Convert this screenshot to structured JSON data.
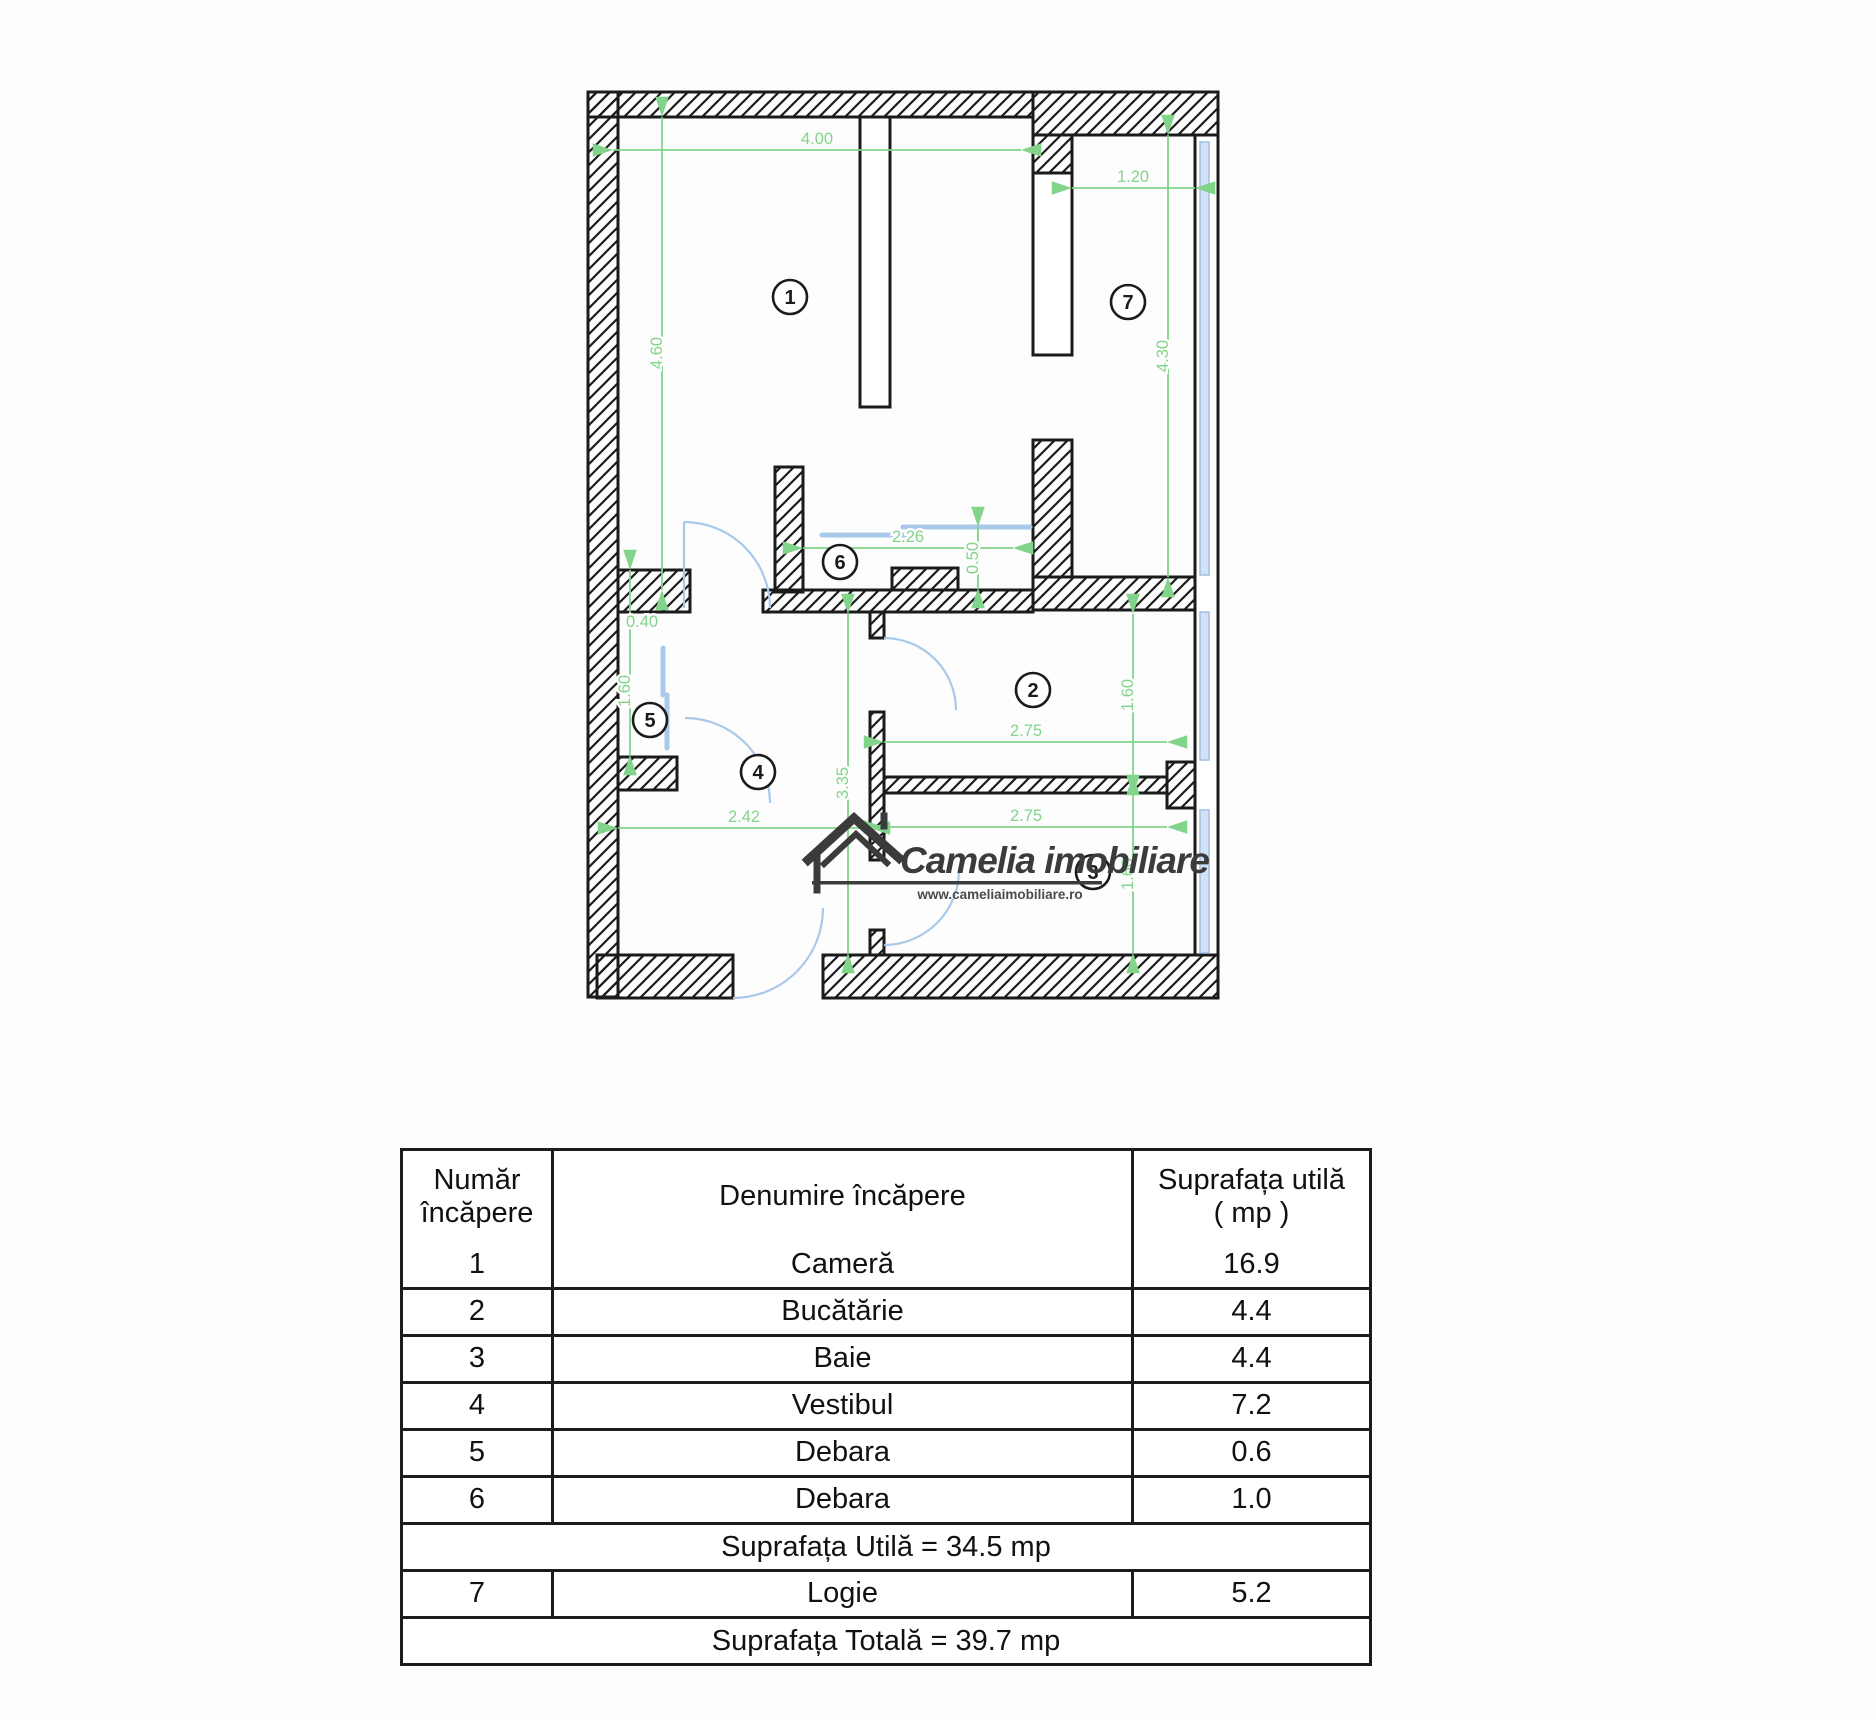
{
  "logo": {
    "name": "Camelia imobiliare",
    "url": "www.cameliaimobiliare.ro"
  },
  "plan": {
    "colors": {
      "dimension_green": "#82d48a",
      "fixture_blue": "#a9c9ea",
      "glass_blue": "#d3e2f4",
      "wall_black": "#1b1b1b",
      "logo_gray": "#3b3b3b"
    },
    "dimensions": [
      {
        "label": "4.00",
        "x1": 143,
        "y1": 100,
        "x2": 551,
        "y2": 100,
        "lx": 347,
        "ly": 94,
        "rot": false
      },
      {
        "label": "4.60",
        "x1": 192,
        "y1": 67,
        "x2": 192,
        "y2": 540,
        "lx": 192,
        "ly": 303,
        "rot": true
      },
      {
        "label": "1.20",
        "x1": 602,
        "y1": 138,
        "x2": 725,
        "y2": 138,
        "lx": 663,
        "ly": 132,
        "rot": false
      },
      {
        "label": "4.30",
        "x1": 698,
        "y1": 85,
        "x2": 698,
        "y2": 527,
        "lx": 698,
        "ly": 306,
        "rot": true
      },
      {
        "label": "2.26",
        "x1": 333,
        "y1": 498,
        "x2": 543,
        "y2": 498,
        "lx": 438,
        "ly": 492,
        "rot": false
      },
      {
        "label": "0.50",
        "x1": 508,
        "y1": 477,
        "x2": 508,
        "y2": 538,
        "lx": 508,
        "ly": 508,
        "rot": true
      },
      {
        "label": "0.40",
        "x1": 160,
        "y1": 520,
        "x2": 160,
        "y2": 705,
        "lx": 172,
        "ly": 577,
        "rot": false
      },
      {
        "label": "1.60",
        "lx": 160,
        "ly": 641,
        "rot": true
      },
      {
        "label": "2.42",
        "x1": 148,
        "y1": 778,
        "x2": 400,
        "y2": 778,
        "lx": 274,
        "ly": 772,
        "rot": false
      },
      {
        "label": "3.35",
        "x1": 378,
        "y1": 564,
        "x2": 378,
        "y2": 903,
        "lx": 378,
        "ly": 733,
        "rot": true
      },
      {
        "label": "2.75",
        "x1": 414,
        "y1": 692,
        "x2": 697,
        "y2": 692,
        "lx": 556,
        "ly": 686,
        "rot": false
      },
      {
        "label": "1.60",
        "x1": 663,
        "y1": 564,
        "x2": 663,
        "y2": 725,
        "lx": 663,
        "ly": 645,
        "rot": true
      },
      {
        "label": "2.75",
        "x1": 414,
        "y1": 777,
        "x2": 697,
        "y2": 777,
        "lx": 556,
        "ly": 771,
        "rot": false
      },
      {
        "label": "1.60",
        "x1": 663,
        "y1": 745,
        "x2": 663,
        "y2": 903,
        "lx": 663,
        "ly": 824,
        "rot": true
      }
    ],
    "rooms": [
      {
        "n": "1",
        "x": 320,
        "y": 247
      },
      {
        "n": "2",
        "x": 563,
        "y": 640
      },
      {
        "n": "3",
        "x": 623,
        "y": 822
      },
      {
        "n": "4",
        "x": 288,
        "y": 722
      },
      {
        "n": "5",
        "x": 180,
        "y": 670
      },
      {
        "n": "6",
        "x": 370,
        "y": 512
      },
      {
        "n": "7",
        "x": 658,
        "y": 252
      }
    ]
  },
  "table": {
    "headers": {
      "col1": "Număr încăpere",
      "col2": "Denumire încăpere",
      "col3_line1": "Suprafața utilă",
      "col3_line2": "( mp )"
    },
    "rows": [
      {
        "num": "1",
        "name": "Cameră",
        "area": "16.9"
      },
      {
        "num": "2",
        "name": "Bucătărie",
        "area": "4.4"
      },
      {
        "num": "3",
        "name": "Baie",
        "area": "4.4"
      },
      {
        "num": "4",
        "name": "Vestibul",
        "area": "7.2"
      },
      {
        "num": "5",
        "name": "Debara",
        "area": "0.6"
      },
      {
        "num": "6",
        "name": "Debara",
        "area": "1.0"
      }
    ],
    "subtotal_label": "Suprafața Utilă = 34.5 mp",
    "logie_row": {
      "num": "7",
      "name": "Logie",
      "area": "5.2"
    },
    "total_label": "Suprafața Totală = 39.7 mp"
  }
}
